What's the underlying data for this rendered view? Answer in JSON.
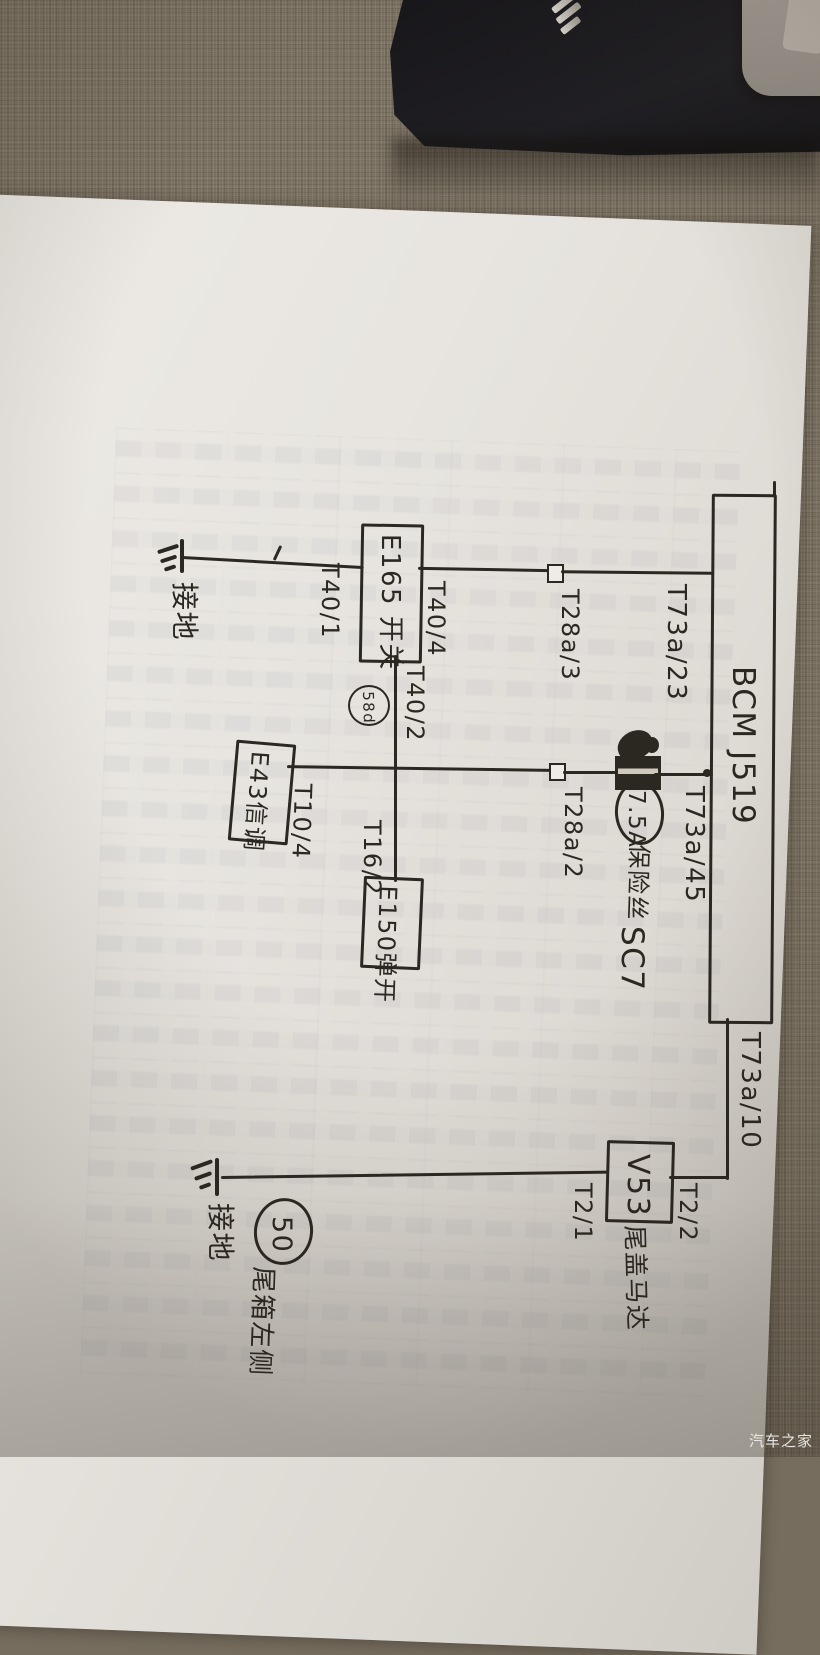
{
  "watermark": {
    "text": "汽车之家"
  },
  "colors": {
    "ink": "#2b2721",
    "paper": "#e9e6e1",
    "fabric": "#7b7263",
    "dark_object": "#17161a",
    "gray_object": "#a09a93",
    "watermark_text": "#f2f0ed"
  },
  "diagram": {
    "bcm": {
      "label": "BCM J519"
    },
    "terminals": {
      "t73a_23": "T73a/23",
      "t73a_45": "T73a/45",
      "t73a_10": "T73a/10",
      "t40_1": "T40/1",
      "t40_4": "T40/4",
      "t40_2": "T40/2",
      "t28a_3": "T28a/3",
      "t28a_2": "T28a/2",
      "t10_4": "T10/4",
      "t16_2": "T16/2",
      "t2_2": "T2/2",
      "t2_1": "T2/1"
    },
    "components": {
      "e165": "E165 开关",
      "e43": "E43信调",
      "e150": "E150弹开",
      "v53": "V53",
      "v53_name": "尾盖马达"
    },
    "fuse": {
      "rating": "7.5A",
      "name": "保险丝",
      "circuit": "SC7"
    },
    "node_58d": "58d",
    "ground_top": "接地",
    "ground_bottom": "接地",
    "ground_point": {
      "number": "50",
      "location": "尾箱左侧"
    }
  }
}
